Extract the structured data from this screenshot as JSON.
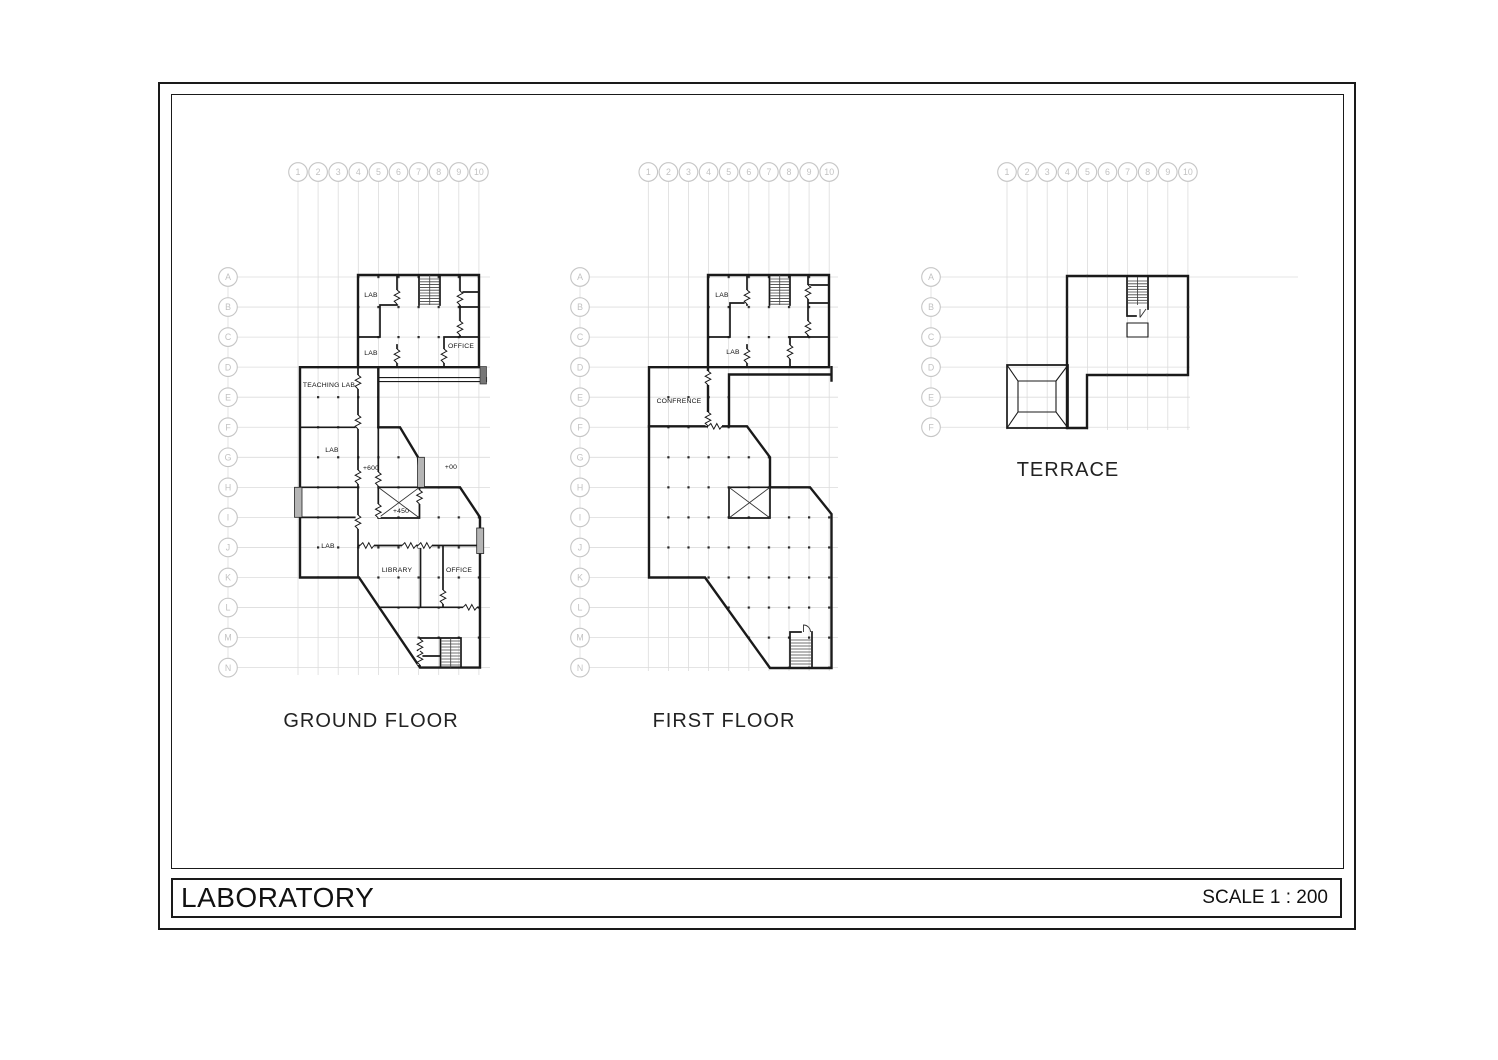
{
  "sheet": {
    "project_title": "LABORATORY",
    "scale_label": "SCALE 1 : 200"
  },
  "grid": {
    "columns": [
      "1",
      "2",
      "3",
      "4",
      "5",
      "6",
      "7",
      "8",
      "9",
      "10"
    ],
    "rows": [
      "A",
      "B",
      "C",
      "D",
      "E",
      "F",
      "G",
      "H",
      "I",
      "J",
      "K",
      "L",
      "M",
      "N"
    ]
  },
  "plans": {
    "ground": {
      "title": "GROUND FLOOR",
      "rooms": {
        "lab_upper": "LAB",
        "lab_mid": "LAB",
        "office_upper": "OFFICE",
        "teaching_lab": "TEACHING LAB",
        "lab_west": "LAB",
        "lab_southwest": "LAB",
        "library": "LIBRARY",
        "office_lower": "OFFICE",
        "level_corridor": "+600",
        "level_entry": "+00",
        "level_landing": "+450"
      }
    },
    "first": {
      "title": "FIRST FLOOR",
      "rooms": {
        "lab_upper": "LAB",
        "lab_mid": "LAB",
        "conference": "CONFRENCE"
      }
    },
    "terrace": {
      "title": "TERRACE"
    }
  }
}
